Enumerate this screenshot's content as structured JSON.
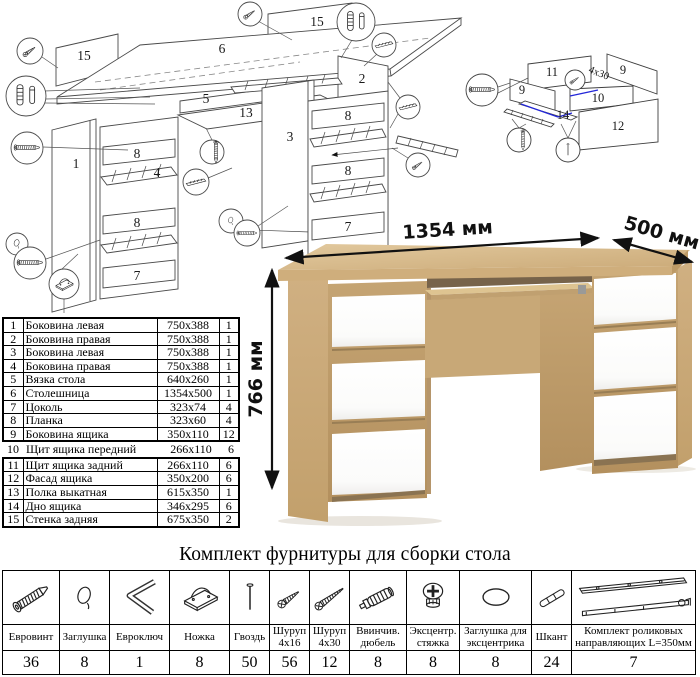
{
  "render": {
    "dim_width": "1354 мм",
    "dim_depth": "500 мм",
    "dim_height": "766 мм",
    "colors": {
      "oak": "#d3b386",
      "oak_dark": "#bd9a68",
      "drawer_white": "#ffffff"
    }
  },
  "diagram_main": {
    "labels": [
      {
        "t": "15"
      },
      {
        "t": "6"
      },
      {
        "t": "15"
      },
      {
        "t": "1"
      },
      {
        "t": "8"
      },
      {
        "t": "4"
      },
      {
        "t": "8"
      },
      {
        "t": "7"
      },
      {
        "t": "5"
      },
      {
        "t": "13"
      },
      {
        "t": "3"
      },
      {
        "t": "2"
      },
      {
        "t": "8"
      },
      {
        "t": "8"
      },
      {
        "t": "7"
      }
    ]
  },
  "diagram_drawer": {
    "labels": [
      {
        "t": "11"
      },
      {
        "t": "9"
      },
      {
        "t": "9"
      },
      {
        "t": "10"
      },
      {
        "t": "14"
      },
      {
        "t": "12"
      }
    ],
    "note": "4x30",
    "accent": "#2326d8"
  },
  "parts_table": {
    "rows_top": [
      {
        "num": "1",
        "name": "Боковина левая",
        "size": "750x388",
        "qty": "1"
      },
      {
        "num": "2",
        "name": "Боковина правая",
        "size": "750x388",
        "qty": "1"
      },
      {
        "num": "3",
        "name": "Боковина левая",
        "size": "750x388",
        "qty": "1"
      },
      {
        "num": "4",
        "name": "Боковина правая",
        "size": "750x388",
        "qty": "1"
      },
      {
        "num": "5",
        "name": "Вязка стола",
        "size": "640x260",
        "qty": "1"
      },
      {
        "num": "6",
        "name": "Столешница",
        "size": "1354x500",
        "qty": "1"
      },
      {
        "num": "7",
        "name": "Цоколь",
        "size": "323x74",
        "qty": "4"
      },
      {
        "num": "8",
        "name": "Планка",
        "size": "323x60",
        "qty": "4"
      },
      {
        "num": "9",
        "name": "Боковина ящика",
        "size": "350x110",
        "qty": "12"
      }
    ],
    "row_mid": {
      "num": "10",
      "name": "Щит ящика передний",
      "size": "266x110",
      "qty": "6"
    },
    "rows_bottom": [
      {
        "num": "11",
        "name": "Щит ящика задний",
        "size": "266x110",
        "qty": "6"
      },
      {
        "num": "12",
        "name": "Фасад ящика",
        "size": "350x200",
        "qty": "6"
      },
      {
        "num": "13",
        "name": "Полка выкатная",
        "size": "615x350",
        "qty": "1"
      },
      {
        "num": "14",
        "name": "Дно ящика",
        "size": "346x295",
        "qty": "6"
      },
      {
        "num": "15",
        "name": "Стенка задняя",
        "size": "675x350",
        "qty": "2"
      }
    ]
  },
  "hardware": {
    "title": "Комплект фурнитуры для сборки стола",
    "items": [
      {
        "icon": "euro-screw",
        "name": "Евровинт",
        "qty": "36"
      },
      {
        "icon": "cap",
        "name": "Заглушка",
        "qty": "8"
      },
      {
        "icon": "hex-key",
        "name": "Евроключ",
        "qty": "1"
      },
      {
        "icon": "foot",
        "name": "Ножка",
        "qty": "8"
      },
      {
        "icon": "nail",
        "name": "Гвоздь",
        "qty": "50"
      },
      {
        "icon": "screw-4x16",
        "name": "Шуруп 4x16",
        "qty": "56"
      },
      {
        "icon": "screw-4x30",
        "name": "Шуруп 4x30",
        "qty": "12"
      },
      {
        "icon": "screw-in-dowel",
        "name": "Ввинчив. дюбель",
        "qty": "8"
      },
      {
        "icon": "cam-lock",
        "name": "Эксцентр. стяжка",
        "qty": "8"
      },
      {
        "icon": "cam-cap",
        "name": "Заглушка для эксцентрика",
        "qty": "8"
      },
      {
        "icon": "wood-dowel",
        "name": "Шкант",
        "qty": "24"
      },
      {
        "icon": "drawer-slide",
        "name": "Комплект роликовых направляющих L=350мм",
        "qty": "7"
      }
    ]
  }
}
